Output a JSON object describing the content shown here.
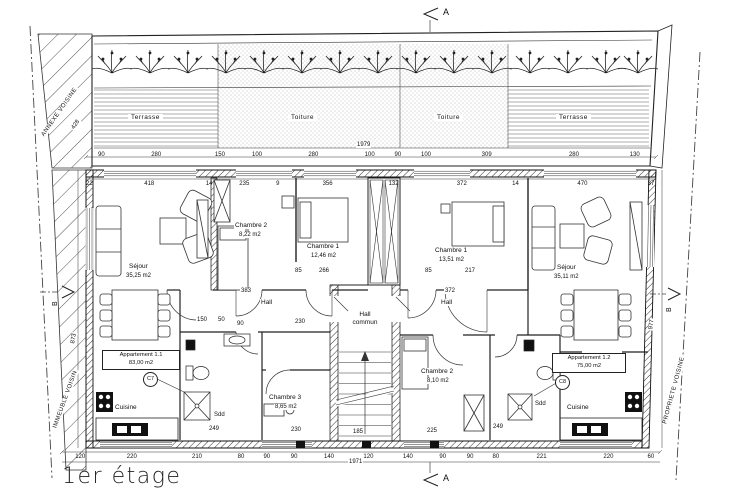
{
  "title": "1er étage",
  "neighbors": {
    "annexe": "ANNEXE VOISINE",
    "immeuble": "IMMEUBLE VOISIN",
    "propriete": "PROPRIETE VOISINE"
  },
  "roof_zones": {
    "terrasse_left": "Terrasse",
    "toiture_left": "Toiture",
    "toiture_right": "Toiture",
    "terrasse_right": "Terrasse"
  },
  "markers": {
    "section_top": "A",
    "section_bottom": "A",
    "section_left": "B",
    "section_right": "B",
    "door_left": "C7",
    "door_right": "C8"
  },
  "apartments": {
    "apt_1_1": {
      "name": "Appartement 1.1",
      "area": "83,00 m2"
    },
    "apt_1_2": {
      "name": "Appartement 1.2",
      "area": "75,00 m2"
    }
  },
  "rooms": {
    "sejour_left": {
      "name": "Séjour",
      "area": "35,25 m2"
    },
    "chambre2_left": {
      "name": "Chambre 2",
      "area": "8,22 m2"
    },
    "chambre1_left": {
      "name": "Chambre 1",
      "area": "12,46 m2"
    },
    "chambre1_right": {
      "name": "Chambre 1",
      "area": "13,51 m2"
    },
    "sejour_right": {
      "name": "Séjour",
      "area": "35,11 m2"
    },
    "hall_left": {
      "name": "Hall"
    },
    "hall_commun": {
      "name": "Hall",
      "name2": "commun"
    },
    "hall_right": {
      "name": "Hall"
    },
    "chambre3_left": {
      "name": "Chambre 3",
      "area": "8,65 m2"
    },
    "chambre2_right": {
      "name": "Chambre 2",
      "area": "8,10 m2"
    },
    "cuisine_left": {
      "name": "Cuisine"
    },
    "cuisine_right": {
      "name": "Cuisine"
    },
    "sdd_left": {
      "name": "Sdd"
    },
    "sdd_right": {
      "name": "Sdd"
    }
  },
  "dimensions": {
    "total_top": "1979",
    "total_bottom": "1971",
    "left_height": "873",
    "right_height": "977",
    "annexe_width": "428",
    "terrace_row": [
      "90",
      "280",
      "150",
      "100",
      "280",
      "100",
      "90",
      "100",
      "309",
      "280",
      "130"
    ],
    "room_row": [
      "22",
      "418",
      "14",
      "235",
      "9",
      "356",
      "132",
      "372",
      "14",
      "470",
      "37"
    ],
    "bottom_row": [
      "120",
      "220",
      "210",
      "80",
      "90",
      "90",
      "140",
      "120",
      "140",
      "90",
      "90",
      "80",
      "221",
      "220",
      "60"
    ],
    "hall_left_width": "383",
    "hall_right_width": "372",
    "upper_inner": [
      "85",
      "266",
      "85",
      "217"
    ],
    "bath_inner": [
      "150",
      "50",
      "90",
      "230"
    ],
    "lower_inner": [
      "249",
      "230",
      "185",
      "225",
      "249"
    ]
  }
}
